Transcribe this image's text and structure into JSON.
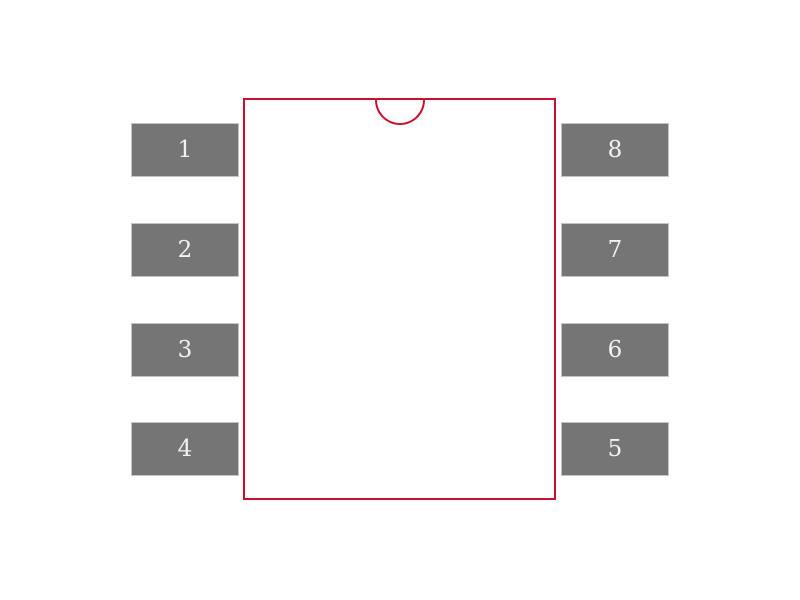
{
  "footprint": {
    "kind": "8-pad dual-row package footprint",
    "pads": {
      "left": [
        "1",
        "2",
        "3",
        "4"
      ],
      "right": [
        "8",
        "7",
        "6",
        "5"
      ]
    },
    "colors": {
      "body_outline": "#C8102E",
      "pad_fill": "#757575",
      "pad_text": "#F2F2F2",
      "background": "#FFFFFF"
    }
  }
}
